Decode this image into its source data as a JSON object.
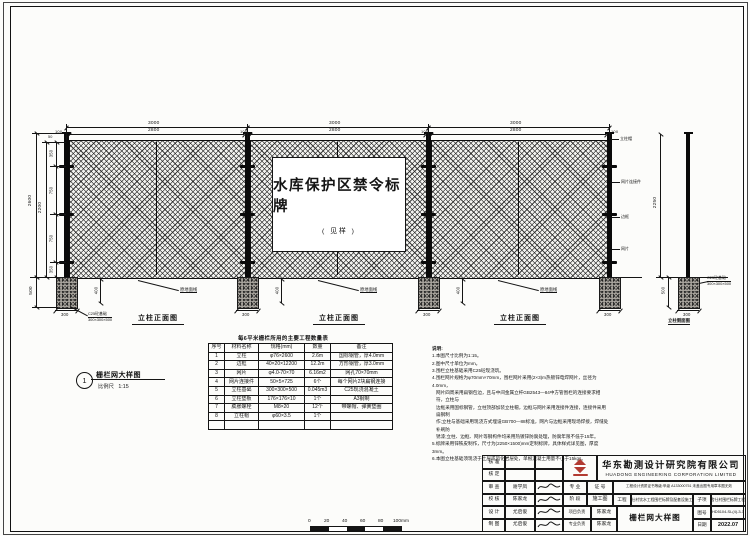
{
  "fence": {
    "dims": {
      "d3000": "3000",
      "d2800": "2800",
      "d100": "100",
      "d50": "50",
      "d2600": "2600",
      "d2200": "2200",
      "d350": "350",
      "d750": "750",
      "d500": "500",
      "d400": "400",
      "d300": "300",
      "d2250": "2250"
    },
    "sign_line1": "水库保护区禁令标牌",
    "sign_line2": "( 见样 )",
    "front_view_label": "立柱正面图",
    "side_view_label": "立柱侧面图",
    "callouts": {
      "ground": "原地面线",
      "cap": "立柱帽",
      "connector": "网片连接件",
      "frame": "边框",
      "mesh": "网片",
      "foundation_l1": "C25砼基础",
      "foundation_l2": "300×300×500"
    }
  },
  "viewport": {
    "number": "1",
    "title": "栅栏网大样图",
    "scale_label": "比例尺",
    "scale_value": "1:15"
  },
  "scalebar": {
    "labels": [
      "0",
      "20",
      "40",
      "60",
      "80",
      "100mm"
    ]
  },
  "materials_table": {
    "title": "每6平米栅栏所用的主要工程数量表",
    "headers": [
      "序号",
      "材料名称",
      "规格(mm)",
      "数量",
      "备注"
    ],
    "rows": [
      [
        "1",
        "立柱",
        "φ76×2600",
        "2.6m",
        "国标钢管，厚4.0mm"
      ],
      [
        "2",
        "边框",
        "40×20×12200",
        "12.2m",
        "方形钢管，厚3.0mm"
      ],
      [
        "3",
        "网片",
        "φ4.0-70×70",
        "6.16m2",
        "网孔70×70mm"
      ],
      [
        "4",
        "网片连接件",
        "50×5×725",
        "6个",
        "每个网片2块扁钢连接"
      ],
      [
        "5",
        "立柱基础",
        "300×300×500",
        "0.045m3",
        "C25现浇混凝土"
      ],
      [
        "6",
        "立柱垫板",
        "176×176×10",
        "1个",
        "A3钢制"
      ],
      [
        "7",
        "膨胀螺栓",
        "M8×20",
        "12个",
        "带螺帽、弹簧垫圈"
      ],
      [
        "8",
        "立柱帽",
        "φ60×3.5",
        "1个",
        ""
      ],
      [
        "",
        "",
        "",
        "",
        ""
      ]
    ]
  },
  "notes": {
    "title": "说明:",
    "lines": [
      "1.本图尺寸比例为1:15。",
      "2.图中尺寸单位为mm。",
      "3.围栏立柱基础采用C25砼现浇筑。",
      "4.围栏网片规格为φ70mm×70mm，围栏网片采用(2×3)m热镀锌电焊网片，丝径为4.0mm，",
      "网片四周采用扁钢包边，且与中间金属立杆GB2543—84中方管围栏的连接要求相符，立柱与",
      "边框采用国标钢管，立柱顶部加装立柱帽，边框与网片采用连接件连接，连接件采用扁钢制",
      "作;立柱与基础采用现浇方式埋设GB700—88标准，网片与边框采用现场焊接，焊缝处补刷防",
      "锈漆;立柱、边框、网片等钢构件均采用热镀锌防腐处理，防腐年限不低于15年。",
      "5.标牌采用锌铁皮制作，尺寸为(2250×1500)mm定制标牌，具体样式详见图，厚度3mm。",
      "6.本图立柱基础须现浇于土层或风化岩层处，单根混凝土用量不小于15kgs。"
    ]
  },
  "titleblock": {
    "company_cn": "华东勘测设计研究院有限公司",
    "company_en": "HUADONG ENGINEERING CORPORATION LIMITED",
    "sign_labels": {
      "approve": "核 准",
      "ratify": "核 定",
      "review": "审 查",
      "check": "校 核",
      "design": "设 计",
      "draft": "制 图"
    },
    "names": {
      "review": "谢学凤",
      "check": "陈家龙",
      "design": "尤启俊",
      "draft": "尤启俊",
      "pm": "陈家龙",
      "lead": "陈家龙"
    },
    "labels": {
      "major": "专 业",
      "cert": "证 号",
      "stage": "阶 段",
      "stage_value": "施工图",
      "project": "工程",
      "subitem": "子项",
      "pm": "项目负责",
      "lead": "专业负责",
      "figno": "图号",
      "date": "日期"
    },
    "qualification": "工程设计资质证书等级:甲级 A133000751 未盖出图专用章本图无效",
    "project_name": "舍仕村饮水工程围栏标牌及配套设施工程",
    "subitem_name": "舍仕村围栏标牌工程",
    "drawing_title": "栅栏网大样图",
    "figno_value": "HD5104-SL(4)-3-1",
    "date_value": "2022.07"
  }
}
